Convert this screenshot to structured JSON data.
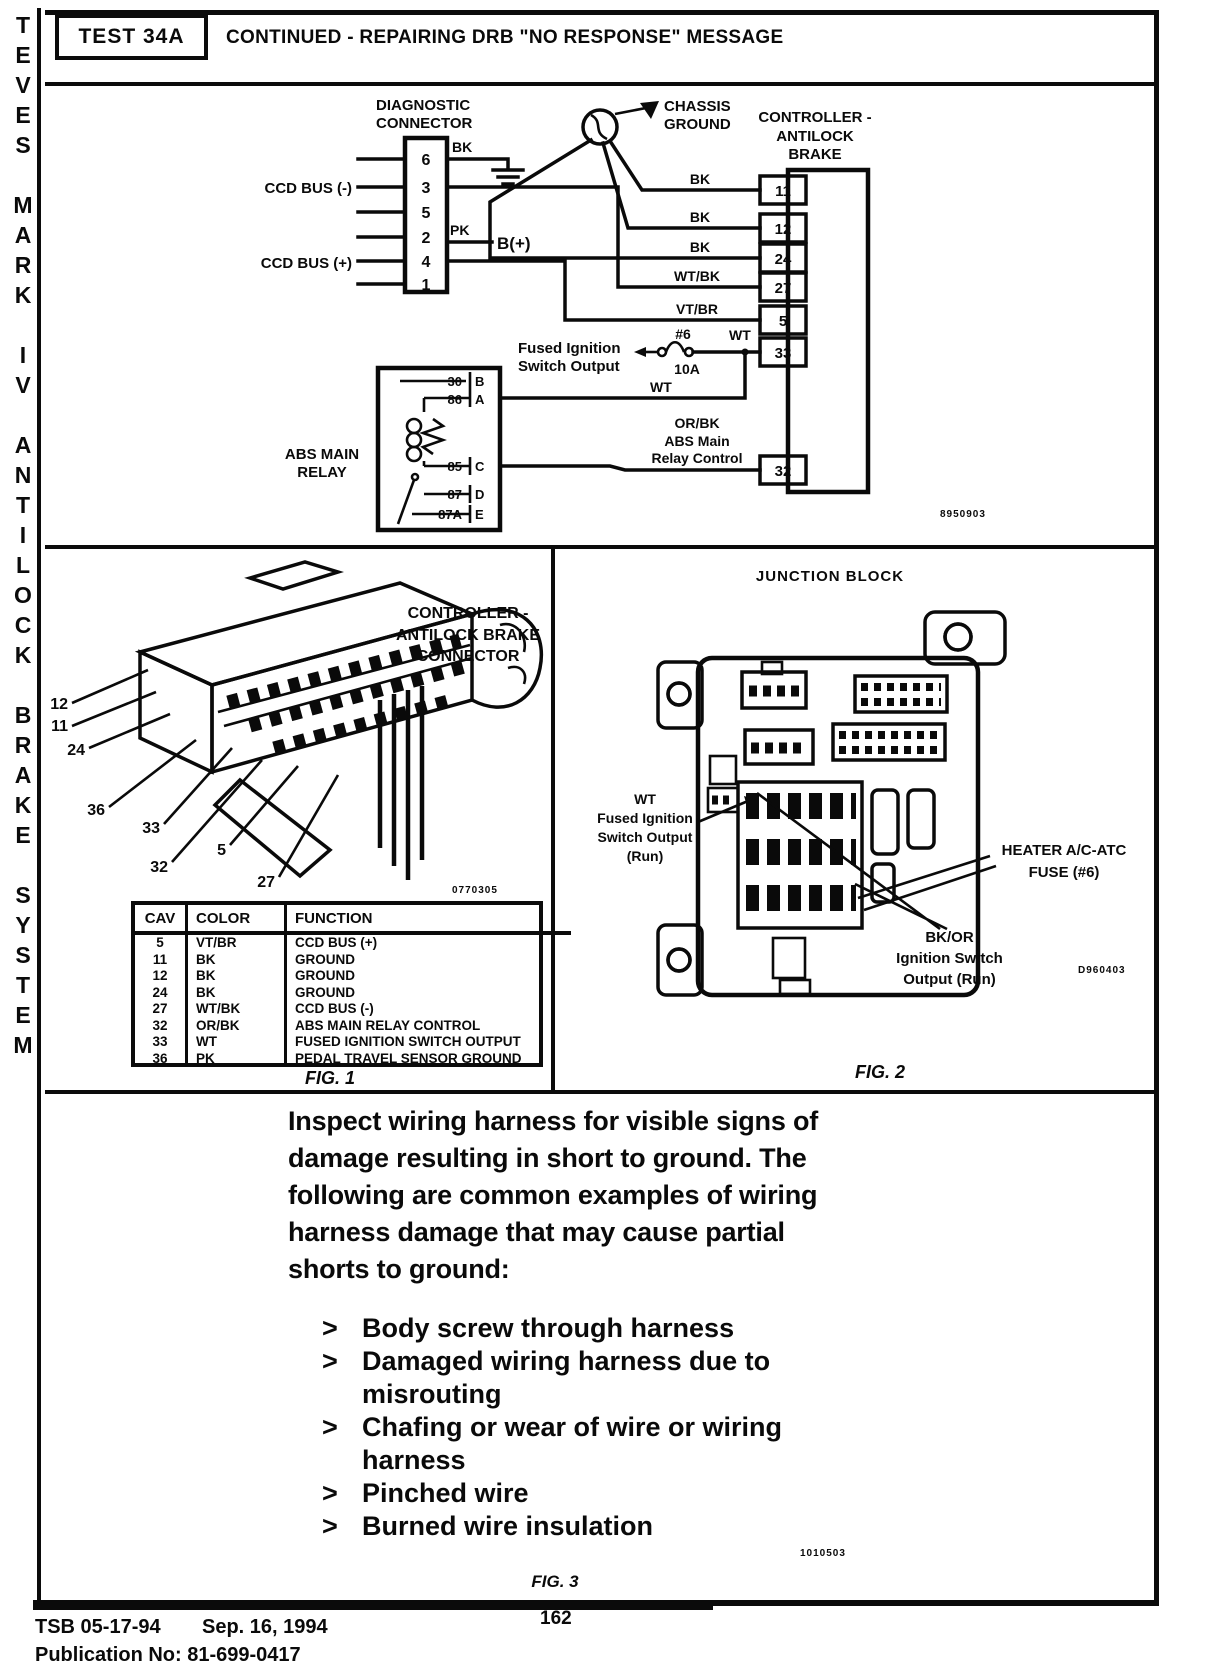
{
  "sidebar": {
    "text": "TEVES MARK IV ANTILOCK BRAKE SYSTEM"
  },
  "header": {
    "test_label": "TEST 34A",
    "title": "CONTINUED - REPAIRING DRB \"NO RESPONSE\" MESSAGE"
  },
  "wiring": {
    "diag": {
      "label": [
        "DIAGNOSTIC",
        "CONNECTOR"
      ],
      "pins": [
        "6",
        "3",
        "5",
        "2",
        "4",
        "1"
      ],
      "ccd_minus": "CCD BUS (-)",
      "ccd_plus": "CCD BUS (+)"
    },
    "chassis": [
      "CHASSIS",
      "GROUND"
    ],
    "controller": {
      "label": [
        "CONTROLLER -",
        "ANTILOCK",
        "BRAKE"
      ],
      "pins": [
        "11",
        "12",
        "24",
        "27",
        "5",
        "33",
        "32"
      ]
    },
    "labels": {
      "bk_gnd": "BK",
      "pk": "PK",
      "b_plus": "B(+)",
      "bk_11": "BK",
      "bk_12": "BK",
      "bk_24": "BK",
      "wt_bk": "WT/BK",
      "vt_br": "VT/BR",
      "fuse_num": "#6",
      "fuse_amp": "10A",
      "wt_fuse": "WT",
      "wt_relay": "WT"
    },
    "fused_ignition": [
      "Fused Ignition",
      "Switch Output"
    ],
    "relay": {
      "label": [
        "ABS MAIN",
        "RELAY"
      ],
      "pins": [
        {
          "num": "30",
          "letter": "B"
        },
        {
          "num": "86",
          "letter": "A"
        },
        {
          "num": "85",
          "letter": "C"
        },
        {
          "num": "87",
          "letter": "D"
        },
        {
          "num": "87A",
          "letter": "E"
        }
      ]
    },
    "relay_control": [
      "OR/BK",
      "ABS Main",
      "Relay Control"
    ],
    "code": "8950903"
  },
  "fig1": {
    "title": [
      "CONTROLLER -",
      "ANTILOCK BRAKE",
      "CONNECTOR"
    ],
    "callouts": [
      "12",
      "11",
      "24",
      "36",
      "33",
      "32",
      "5",
      "27"
    ],
    "code": "0770305",
    "table": {
      "headers": [
        "CAV",
        "COLOR",
        "FUNCTION"
      ],
      "rows": [
        {
          "cav": "5",
          "color": "VT/BR",
          "func": "CCD BUS (+)"
        },
        {
          "cav": "11",
          "color": "BK",
          "func": "GROUND"
        },
        {
          "cav": "12",
          "color": "BK",
          "func": "GROUND"
        },
        {
          "cav": "24",
          "color": "BK",
          "func": "GROUND"
        },
        {
          "cav": "27",
          "color": "WT/BK",
          "func": "CCD BUS (-)"
        },
        {
          "cav": "32",
          "color": "OR/BK",
          "func": "ABS MAIN RELAY CONTROL"
        },
        {
          "cav": "33",
          "color": "WT",
          "func": "FUSED IGNITION SWITCH OUTPUT"
        },
        {
          "cav": "36",
          "color": "PK",
          "func": "PEDAL TRAVEL SENSOR GROUND"
        }
      ]
    },
    "caption": "FIG. 1"
  },
  "fig2": {
    "title": "JUNCTION BLOCK",
    "wt_label": [
      "WT",
      "Fused Ignition",
      "Switch Output",
      "(Run)"
    ],
    "heater_label": [
      "HEATER A/C-ATC",
      "FUSE (#6)"
    ],
    "bkor_label": [
      "BK/OR",
      "Ignition Switch",
      "Output (Run)"
    ],
    "code": "D960403",
    "caption": "FIG. 2"
  },
  "fig3": {
    "paragraph": "Inspect wiring harness for visible signs of damage resulting in short to ground.  The following are common examples of wiring harness damage that may cause partial shorts to ground:",
    "marker": ">",
    "bullets": [
      "Body screw through harness",
      "Damaged wiring harness due to misrouting",
      "Chafing or wear of wire or wiring harness",
      "Pinched wire",
      "Burned wire insulation"
    ],
    "code": "1010503",
    "caption": "FIG. 3"
  },
  "footer": {
    "tsb": "TSB 05-17-94",
    "date": "Sep. 16, 1994",
    "page_number": "162",
    "publication": "Publication No: 81-699-0417"
  }
}
